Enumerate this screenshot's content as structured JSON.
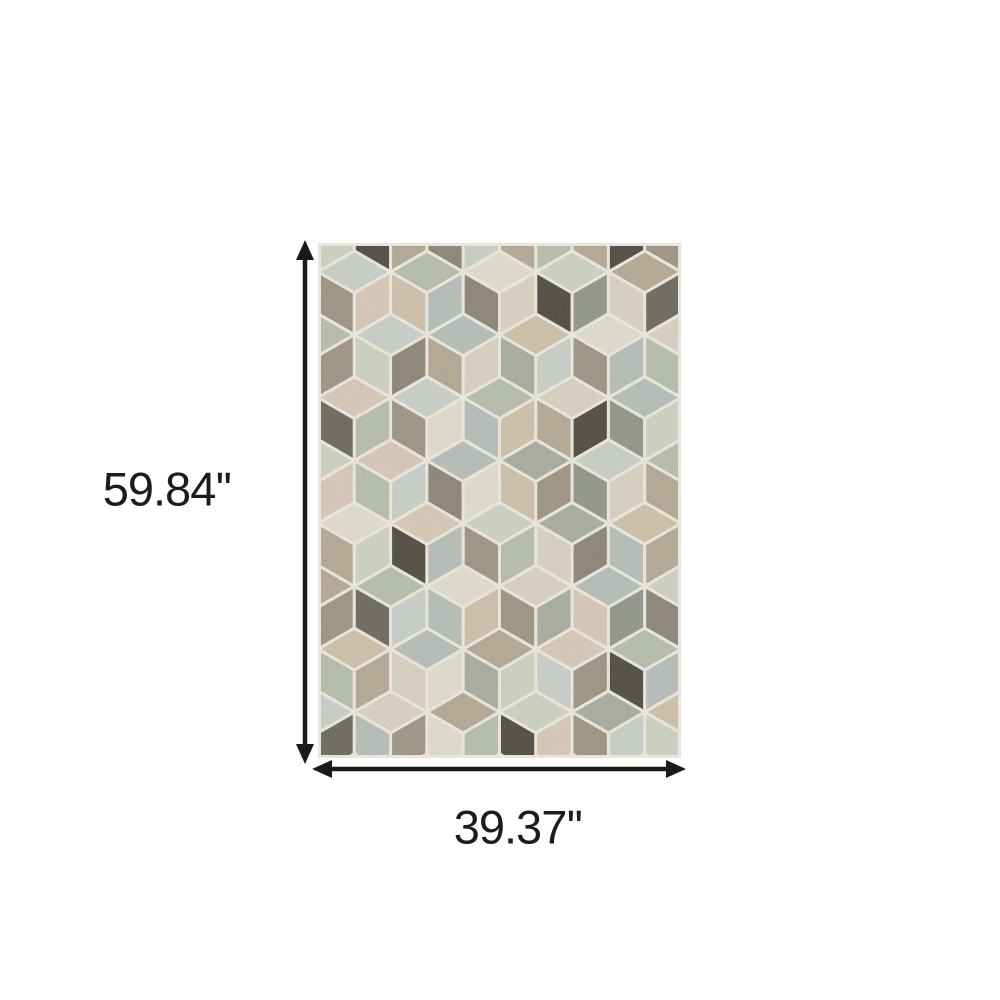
{
  "page": {
    "background": "#ffffff"
  },
  "dimensions": {
    "height_label": "59.84''",
    "width_label": "39.37''",
    "arrow_color": "#191919"
  },
  "rug": {
    "x": 318,
    "y": 243,
    "width": 363,
    "height": 515,
    "cube_width": 72.6,
    "first_row_cy": -13,
    "row_count": 10,
    "grout_color": "#ece8dd",
    "border_color": "#e9e5da",
    "palette": [
      "#b5bda9",
      "#ccd2c0",
      "#d8d1bf",
      "#cec0a7",
      "#d8c7b4",
      "#b2a791",
      "#9c9280",
      "#8a8375",
      "#b5bdb8",
      "#c8cec8",
      "#a6ab9e",
      "#4c483f",
      "#6a665b",
      "#e0dbce",
      "#8f948a"
    ],
    "rows": [
      [
        [
          2,
          6,
          1
        ],
        [
          10,
          11,
          5
        ],
        [
          1,
          7,
          9
        ],
        [
          4,
          5,
          0
        ],
        [
          2,
          5,
          11
        ],
        [
          8,
          6,
          7
        ]
      ],
      [
        [
          3,
          5,
          1
        ],
        [
          9,
          6,
          4
        ],
        [
          0,
          3,
          8
        ],
        [
          13,
          7,
          2
        ],
        [
          1,
          11,
          14
        ],
        [
          5,
          2,
          12
        ],
        [
          4,
          2,
          6
        ]
      ],
      [
        [
          0,
          4,
          6
        ],
        [
          9,
          1,
          7
        ],
        [
          8,
          5,
          2
        ],
        [
          3,
          10,
          9
        ],
        [
          13,
          6,
          8
        ],
        [
          2,
          0,
          5
        ]
      ],
      [
        [
          5,
          2,
          10
        ],
        [
          4,
          12,
          0
        ],
        [
          9,
          6,
          13
        ],
        [
          0,
          8,
          3
        ],
        [
          2,
          5,
          11
        ],
        [
          8,
          14,
          1
        ],
        [
          3,
          9,
          6
        ]
      ],
      [
        [
          1,
          6,
          4
        ],
        [
          4,
          0,
          9
        ],
        [
          8,
          7,
          13
        ],
        [
          10,
          3,
          6
        ],
        [
          9,
          14,
          2
        ],
        [
          0,
          5,
          8
        ]
      ],
      [
        [
          2,
          3,
          14
        ],
        [
          13,
          5,
          1
        ],
        [
          4,
          11,
          8
        ],
        [
          1,
          6,
          0
        ],
        [
          10,
          2,
          7
        ],
        [
          3,
          8,
          5
        ],
        [
          9,
          4,
          2
        ]
      ],
      [
        [
          5,
          1,
          6
        ],
        [
          0,
          12,
          9
        ],
        [
          13,
          8,
          3
        ],
        [
          2,
          6,
          10
        ],
        [
          8,
          4,
          14
        ],
        [
          1,
          7,
          4
        ]
      ],
      [
        [
          6,
          9,
          2
        ],
        [
          3,
          0,
          5
        ],
        [
          8,
          2,
          13
        ],
        [
          5,
          10,
          1
        ],
        [
          4,
          9,
          6
        ],
        [
          0,
          11,
          8
        ],
        [
          2,
          5,
          3
        ]
      ],
      [
        [
          9,
          3,
          12
        ],
        [
          2,
          8,
          6
        ],
        [
          5,
          13,
          0
        ],
        [
          1,
          11,
          4
        ],
        [
          10,
          6,
          9
        ],
        [
          3,
          1,
          7
        ]
      ],
      [
        [
          4,
          1,
          2
        ],
        [
          8,
          5,
          0
        ],
        [
          2,
          6,
          9
        ],
        [
          13,
          3,
          8
        ],
        [
          6,
          0,
          4
        ],
        [
          9,
          2,
          5
        ],
        [
          0,
          8,
          3
        ]
      ]
    ]
  }
}
